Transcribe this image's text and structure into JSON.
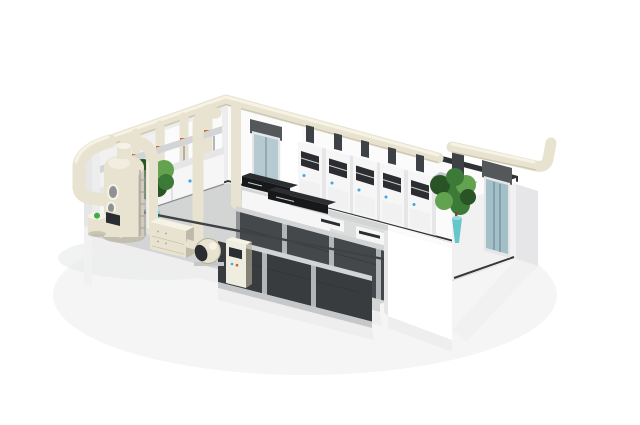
{
  "description": "Isometric 3D rendering of a laboratory with exhaust-gas treatment: cream ventilation ductwork along the wall tops, a scrubber tower with drum, filter box, centrifugal fan and control cabinet outside the cut-away front-left wall, four damper duct risers over a wall bench on the back-left wall, a row of five fume hoods with duct stubs on the back-right wall, an interior door and a glass double door, an exhaust canopy with a duct exiting over the right wall, black benchtop instruments on white benches in the center, two dark cabinet rows along the front, and two green plants in teal cone vases.",
  "palette": {
    "background": "#ffffff",
    "shadow": "#e8e9e9",
    "duct": "#e8e2d0",
    "duct_light": "#f6f2e4",
    "duct_dark": "#b7b099",
    "wall_white": "#fbfbfc",
    "wall_light": "#f1f1f2",
    "wall_shade": "#e6e6e8",
    "wall_inner": "#ededee",
    "wall_cap": "#303335",
    "floor": "#d3d4d4",
    "floor_light": "#dfe0e0",
    "skirting": "#35383b",
    "plinth": "#c6c7c8",
    "foundation": "#eeeeef",
    "rail_light": "#d2d4d5",
    "cabinet_dark": "#45484a",
    "cabinet_darker": "#393c3e",
    "cabinet_frame": "#b3b6b8",
    "cabinet_cream": "#efece0",
    "bench_white": "#f6f6f7",
    "instrument_black": "#17181a",
    "instrument_top": "#2c2d30",
    "rail_dark": "#3f4244",
    "door_header": "#54585b",
    "door_glass": "#b5cad1",
    "door_glass_dark": "#a3c0c9",
    "door_seam": "#6e8d95",
    "sash_bar": "#c8cccd",
    "seam": "#2f3234",
    "dark_stub": "#3e4246",
    "canopy": "#c2c5c6",
    "canopy_edge": "#8e9294",
    "plant": "#3c7a37",
    "plant_dark": "#285426",
    "plant_light": "#63a24f",
    "trunk": "#6c4f35",
    "vase": "#66c7ca",
    "vase_light": "#9adbdc",
    "valve": "#d8621c",
    "accent_blue": "#3fa9dc",
    "green_dot": "#3fae49",
    "metal": "#9aa0a3",
    "panel_white": "#ffffff",
    "screen_dark": "#2b2e30"
  },
  "scene": {
    "objects": [
      {
        "id": "room-floor",
        "label": "laboratory floor slab"
      },
      {
        "id": "back-left-wall",
        "label": "back-left wall with panels"
      },
      {
        "id": "back-right-wall",
        "label": "back-right wall with dark top cap"
      },
      {
        "id": "right-end-wall",
        "label": "right end wall"
      },
      {
        "id": "corner-wall",
        "label": "bright front corner wall"
      },
      {
        "id": "interior-door",
        "label": "interior glass door near back corner"
      },
      {
        "id": "glass-double-door",
        "label": "glass double door on right wall"
      },
      {
        "id": "main-exhaust-duct",
        "label": "cream exhaust duct along wall tops"
      },
      {
        "id": "exit-duct",
        "label": "duct exiting over right wall with upward elbow"
      },
      {
        "id": "exhaust-canopy",
        "label": "fume extraction canopy"
      },
      {
        "id": "duct-riser",
        "label": "vertical duct riser with damper"
      },
      {
        "id": "damper",
        "label": "orange duct damper"
      },
      {
        "id": "wall-bench-left",
        "label": "wall bench with reagent rack"
      },
      {
        "id": "fume-hood",
        "label": "fume hood with dark sash opening and duct stub"
      },
      {
        "id": "instrument-bench",
        "label": "white bench with black benchtop instrument"
      },
      {
        "id": "benchtop-device",
        "label": "small benchtop analyzer"
      },
      {
        "id": "mid-cabinet-row",
        "label": "middle row of dark lab cabinets"
      },
      {
        "id": "front-cabinet-row",
        "label": "front row of dark lab cabinets"
      },
      {
        "id": "service-beam",
        "label": "thin dark service rail crossing the room"
      },
      {
        "id": "scrubber-tower",
        "label": "exhaust gas scrubber tower with ladder and ports"
      },
      {
        "id": "chemical-drum",
        "label": "small drum with green lid"
      },
      {
        "id": "dosing-tank",
        "label": "open dosing tank"
      },
      {
        "id": "filter-box",
        "label": "filter / silencer box"
      },
      {
        "id": "exhaust-fan",
        "label": "centrifugal exhaust fan"
      },
      {
        "id": "fan-discharge-column",
        "label": "vertical fan discharge duct"
      },
      {
        "id": "auxiliary-duct",
        "label": "auxiliary vertical duct with elbow"
      },
      {
        "id": "control-cabinet",
        "label": "control cabinet with dark screen"
      },
      {
        "id": "plant-left",
        "label": "potted plant in teal vase (left)"
      },
      {
        "id": "plant-right",
        "label": "potted plant in teal vase (right)"
      }
    ]
  }
}
